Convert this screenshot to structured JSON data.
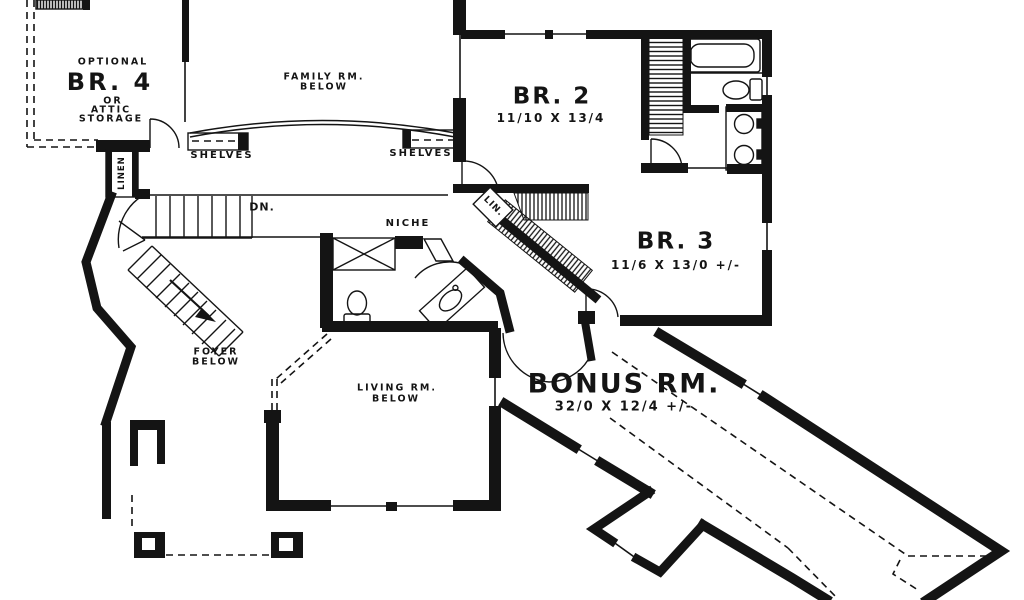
{
  "plan": {
    "title": "second floor plan",
    "colors": {
      "ink": "#141414",
      "paper": "#ffffff"
    },
    "rooms": {
      "br4": {
        "prefix": "OPTIONAL",
        "label": "BR. 4",
        "alt1": "OR",
        "alt2": "ATTIC",
        "alt3": "STORAGE"
      },
      "family": {
        "line1": "FAMILY RM.",
        "line2": "BELOW"
      },
      "br2": {
        "label": "BR. 2",
        "dims": "11/10 X 13/4"
      },
      "br3": {
        "label": "BR. 3",
        "dims": "11/6 X 13/0 +/-"
      },
      "bonus": {
        "label": "BONUS RM.",
        "dims": "32/0 X 12/4 +/-"
      },
      "foyer": {
        "line1": "FOYER",
        "line2": "BELOW"
      },
      "living": {
        "line1": "LIVING RM.",
        "line2": "BELOW"
      }
    },
    "features": {
      "shelves_left": "SHELVES",
      "shelves_right": "SHELVES",
      "linen": "LINEN",
      "lin": "LIN.",
      "down": "DN.",
      "niche": "NICHE"
    }
  }
}
